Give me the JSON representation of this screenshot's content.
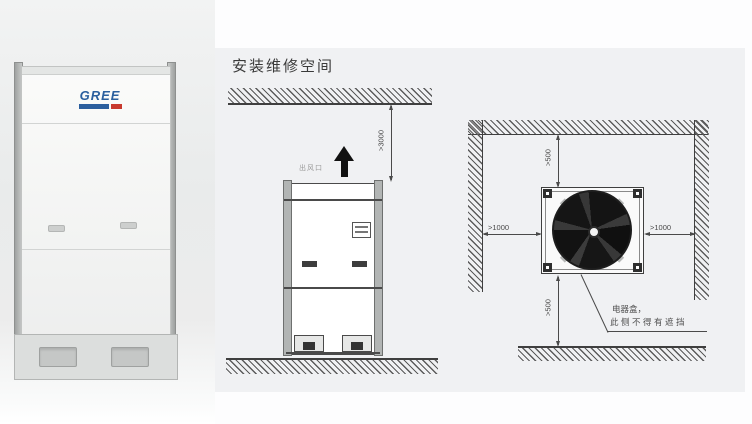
{
  "window": {
    "width": 752,
    "height": 424,
    "background": "#fdfdfe"
  },
  "photo": {
    "description": "outdoor unit product photo",
    "brand": "GREE",
    "brand_color": "#2b5f9e",
    "brand_accent": "#c8392e",
    "background_top": "#f2f3f3",
    "background_mid": "#e9ebeb"
  },
  "panel": {
    "title": "安装维修空间",
    "background": "#f0f1f3",
    "line_color": "#4a4a4a",
    "text_color": "#3a3a3a"
  },
  "side_view": {
    "air_outlet_label": "出风口",
    "top_clearance_label": ">3000"
  },
  "top_view": {
    "back_clearance_label": ">500",
    "front_clearance_label": ">500",
    "left_clearance_label": ">1000",
    "right_clearance_label": ">1000",
    "note_line1": "电器盒，",
    "note_line2": "此侧不得有遮挡"
  }
}
